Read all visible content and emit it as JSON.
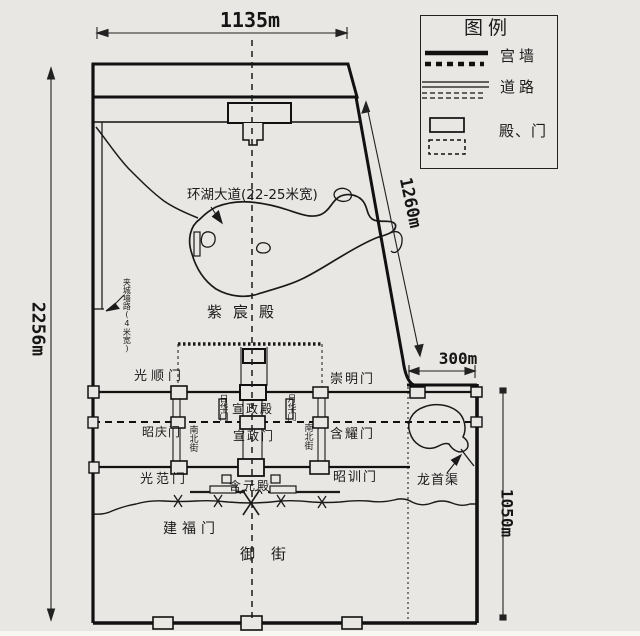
{
  "dimensions": {
    "top_width": "1135m",
    "left_height": "2256m",
    "northeast_wall": "1260m",
    "east_extension_width": "300m",
    "east_height": "1050m"
  },
  "legend": {
    "title": "图例",
    "items": [
      {
        "label": "宫墙",
        "symbol": "thick-solid-and-dotted-line"
      },
      {
        "label": "道路",
        "symbol": "double-thin-and-dashed-line"
      },
      {
        "label": "殿、门",
        "symbol": "solid-and-dashed-rectangle"
      }
    ]
  },
  "labels": {
    "lake_road": "环湖大道(22-25米宽)",
    "jiacheng_note": "夹城墙路(4米宽)",
    "zichen_hall": "紫宸殿",
    "guangshun_gate": "光顺门",
    "chongming_gate": "崇明门",
    "rihua_gate": "日华门",
    "yuehua_gate": "月华门",
    "xuanzheng_hall": "宣政殿",
    "zhaoqing_gate": "昭庆门",
    "north_south_street_west": "南北街",
    "xuanzheng_gate": "宣政门",
    "north_south_street_east": "南北街",
    "hanyao_gate": "含耀门",
    "guangfan_gate": "光范门",
    "zhaoxun_gate": "昭训门",
    "hanyuan_hall": "含元殿",
    "longshou_canal": "龙首渠",
    "jianfu_gate": "建福门",
    "imperial_street": "御街"
  },
  "colors": {
    "paper": "#e9e7e3",
    "ink": "#1a1a1a"
  }
}
